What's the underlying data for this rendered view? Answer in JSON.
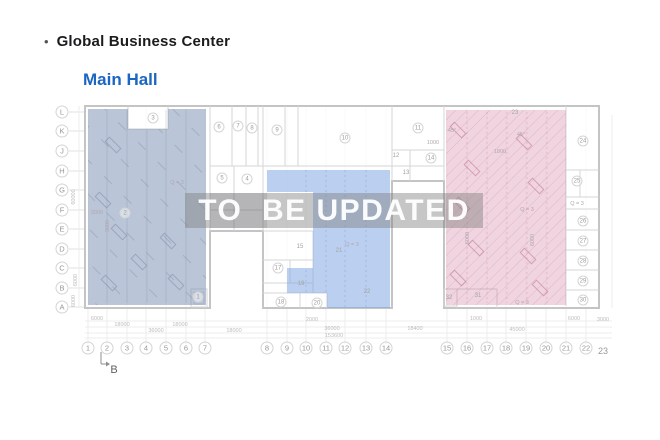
{
  "header": {
    "bullet": "•",
    "title": "Global Business Center",
    "subtitle": "Main Hall",
    "title_color": "#1c1c1e",
    "subtitle_color": "#1a66c2"
  },
  "watermark": {
    "text": "TO  BE UPDATED",
    "band_color": "rgba(128,128,128,0.45)",
    "shade_color": "rgba(60,60,70,0.12)",
    "text_color": "rgba(255,255,255,0.95)"
  },
  "regions": {
    "left": {
      "color": "rgba(130,150,182,0.55)"
    },
    "center": {
      "color": "rgba(120,160,225,0.50)"
    },
    "right": {
      "color": "rgba(200,100,140,0.28)"
    }
  },
  "axes": {
    "letters": [
      {
        "t": "L",
        "y": 112
      },
      {
        "t": "K",
        "y": 131
      },
      {
        "t": "J",
        "y": 151
      },
      {
        "t": "H",
        "y": 171
      },
      {
        "t": "G",
        "y": 190
      },
      {
        "t": "F",
        "y": 210
      },
      {
        "t": "E",
        "y": 229
      },
      {
        "t": "D",
        "y": 249
      },
      {
        "t": "C",
        "y": 268
      },
      {
        "t": "B",
        "y": 288
      },
      {
        "t": "A",
        "y": 307
      }
    ],
    "numbers": [
      {
        "t": "1",
        "x": 88
      },
      {
        "t": "2",
        "x": 107
      },
      {
        "t": "3",
        "x": 127
      },
      {
        "t": "4",
        "x": 146
      },
      {
        "t": "5",
        "x": 166
      },
      {
        "t": "6",
        "x": 186
      },
      {
        "t": "7",
        "x": 205
      },
      {
        "t": "8",
        "x": 267
      },
      {
        "t": "9",
        "x": 287
      },
      {
        "t": "10",
        "x": 306
      },
      {
        "t": "11",
        "x": 326
      },
      {
        "t": "12",
        "x": 345
      },
      {
        "t": "13",
        "x": 366
      },
      {
        "t": "14",
        "x": 386
      },
      {
        "t": "15",
        "x": 447
      },
      {
        "t": "16",
        "x": 467
      },
      {
        "t": "17",
        "x": 487
      },
      {
        "t": "18",
        "x": 506
      },
      {
        "t": "19",
        "x": 526
      },
      {
        "t": "20",
        "x": 546
      },
      {
        "t": "21",
        "x": 566
      },
      {
        "t": "22",
        "x": 586
      },
      {
        "t": "23",
        "x": 603,
        "y": 351,
        "plain": true
      }
    ]
  },
  "rooms": [
    {
      "t": "1",
      "x": 198,
      "y": 297,
      "c": true
    },
    {
      "t": "2",
      "x": 125,
      "y": 213,
      "c": true
    },
    {
      "t": "3",
      "x": 153,
      "y": 118,
      "c": true
    },
    {
      "t": "4",
      "x": 247,
      "y": 179,
      "c": true
    },
    {
      "t": "5",
      "x": 222,
      "y": 178,
      "c": true
    },
    {
      "t": "6",
      "x": 219,
      "y": 127,
      "c": true
    },
    {
      "t": "7",
      "x": 238,
      "y": 126,
      "c": true
    },
    {
      "t": "8",
      "x": 252,
      "y": 128,
      "c": true
    },
    {
      "t": "9",
      "x": 277,
      "y": 130,
      "c": true
    },
    {
      "t": "10",
      "x": 345,
      "y": 138,
      "c": true
    },
    {
      "t": "11",
      "x": 418,
      "y": 128,
      "c": true
    },
    {
      "t": "12",
      "x": 396,
      "y": 156
    },
    {
      "t": "13",
      "x": 406,
      "y": 173
    },
    {
      "t": "14",
      "x": 431,
      "y": 158,
      "c": true
    },
    {
      "t": "15",
      "x": 300,
      "y": 247
    },
    {
      "t": "17",
      "x": 278,
      "y": 268,
      "c": true
    },
    {
      "t": "18",
      "x": 281,
      "y": 302,
      "c": true
    },
    {
      "t": "19",
      "x": 301,
      "y": 284
    },
    {
      "t": "20",
      "x": 317,
      "y": 303,
      "c": true
    },
    {
      "t": "21",
      "x": 339,
      "y": 251
    },
    {
      "t": "22",
      "x": 367,
      "y": 292
    },
    {
      "t": "23",
      "x": 515,
      "y": 113
    },
    {
      "t": "24",
      "x": 583,
      "y": 141,
      "c": true
    },
    {
      "t": "25",
      "x": 577,
      "y": 181,
      "c": true
    },
    {
      "t": "26",
      "x": 583,
      "y": 221,
      "c": true
    },
    {
      "t": "27",
      "x": 583,
      "y": 241,
      "c": true
    },
    {
      "t": "28",
      "x": 583,
      "y": 261,
      "c": true
    },
    {
      "t": "29",
      "x": 583,
      "y": 281,
      "c": true
    },
    {
      "t": "30",
      "x": 583,
      "y": 300,
      "c": true
    },
    {
      "t": "31",
      "x": 478,
      "y": 296
    },
    {
      "t": "32",
      "x": 449,
      "y": 298
    }
  ],
  "dims": [
    {
      "t": "6000",
      "x": 97,
      "y": 319
    },
    {
      "t": "18000",
      "x": 122,
      "y": 325
    },
    {
      "t": "18000",
      "x": 180,
      "y": 325
    },
    {
      "t": "36000",
      "x": 156,
      "y": 331
    },
    {
      "t": "18000",
      "x": 234,
      "y": 331
    },
    {
      "t": "2000",
      "x": 312,
      "y": 320
    },
    {
      "t": "36000",
      "x": 332,
      "y": 329
    },
    {
      "t": "153600",
      "x": 334,
      "y": 336
    },
    {
      "t": "18400",
      "x": 415,
      "y": 329
    },
    {
      "t": "1000",
      "x": 476,
      "y": 319
    },
    {
      "t": "45000",
      "x": 517,
      "y": 330
    },
    {
      "t": "6000",
      "x": 574,
      "y": 319
    },
    {
      "t": "3000",
      "x": 603,
      "y": 320
    },
    {
      "t": "60000",
      "x": 74,
      "y": 197,
      "r": true
    },
    {
      "t": "6000",
      "x": 76,
      "y": 280,
      "r": true
    },
    {
      "t": "6000",
      "x": 74,
      "y": 301,
      "r": true
    }
  ],
  "annotations": [
    {
      "t": "Q = 3",
      "x": 177,
      "y": 183
    },
    {
      "t": "Q = 3",
      "x": 352,
      "y": 245
    },
    {
      "t": "Q = 3",
      "x": 527,
      "y": 210
    },
    {
      "t": "Q = 3",
      "x": 577,
      "y": 204
    },
    {
      "t": "Q = 3",
      "x": 522,
      "y": 303
    },
    {
      "t": "45°",
      "x": 452,
      "y": 131
    },
    {
      "t": "45°",
      "x": 521,
      "y": 135
    },
    {
      "t": "1800",
      "x": 500,
      "y": 152
    },
    {
      "t": "1000",
      "x": 433,
      "y": 143
    },
    {
      "t": "6000",
      "x": 468,
      "y": 238,
      "r": true
    },
    {
      "t": "6000",
      "x": 533,
      "y": 240,
      "r": true
    },
    {
      "t": "2000",
      "x": 97,
      "y": 213
    },
    {
      "t": "3000",
      "x": 108,
      "y": 226,
      "r": true
    }
  ],
  "section_marker": {
    "label": "B"
  }
}
